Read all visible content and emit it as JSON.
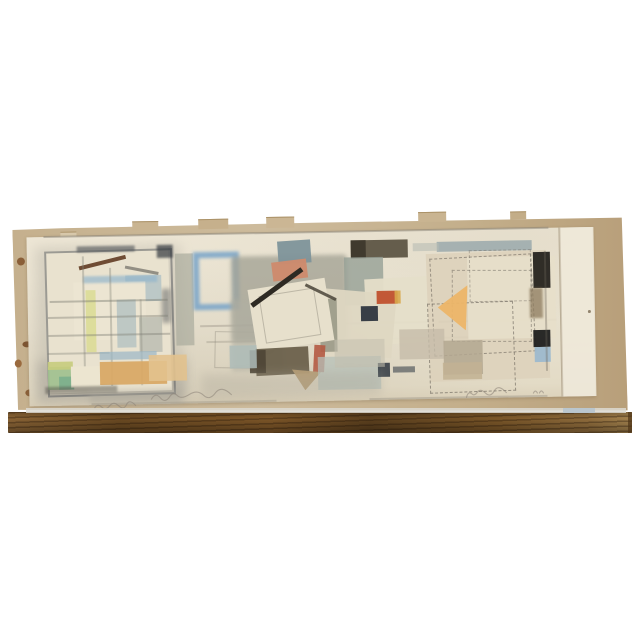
{
  "meta": {
    "scene": "product photograph of an abstract horizontal painting on paper resting on a wooden ledge against a white wall",
    "artwork_style": "mid-century abstract watercolor and collage with pencil grid, three cluster zones"
  },
  "palette": {
    "background": "#ffffff",
    "wood_dark": "#5c401e",
    "wood_mid": "#7d5628",
    "wood_light": "#a3824e",
    "ledge_highlight": "#dcd9d1",
    "ledge_highlight_blue": "#b7c4cd",
    "backing_tan": "#c8b38f",
    "paper_cream": "#e9e2d0",
    "pencil": "#8a8478",
    "charcoal": "#3f444b",
    "wash_gray": "#a5a496",
    "crayon_blue": "#6f9fc8",
    "slate_blue": "#7e939a",
    "salmon": "#cf8a6d",
    "umber": "#5e5544",
    "red_accent": "#c0512e",
    "navy": "#262e38",
    "ochre": "#ecb568",
    "tan_block": "#d9a966",
    "green_block": "#9fc08d",
    "black_block": "#1f1f1f",
    "light_blue_square": "#9db9ce"
  },
  "inscriptions": [
    {
      "name": "inscription-bottom-left",
      "medium": "pencil",
      "legibility": "illegible faint script"
    },
    {
      "name": "inscription-bottom-center",
      "medium": "pencil",
      "legibility": "illegible faint script title"
    },
    {
      "name": "inscription-signature-right",
      "medium": "pencil",
      "legibility": "illegible faint signature"
    },
    {
      "name": "inscription-date-mark",
      "medium": "pencil",
      "legibility": "tiny faint two-character mark"
    }
  ],
  "backing": {
    "tabs": [
      {
        "n": "torn-tab",
        "x": 134,
        "y": 218,
        "w": 26,
        "h": 8,
        "c": "#c9b491"
      },
      {
        "n": "torn-tab",
        "x": 200,
        "y": 217,
        "w": 30,
        "h": 9,
        "c": "#c6b08c"
      },
      {
        "n": "torn-tab",
        "x": 268,
        "y": 216,
        "w": 28,
        "h": 10,
        "c": "#cbb694"
      },
      {
        "n": "torn-tab",
        "x": 420,
        "y": 214,
        "w": 28,
        "h": 9,
        "c": "#c9b491"
      },
      {
        "n": "torn-tab",
        "x": 512,
        "y": 215,
        "w": 16,
        "h": 7,
        "c": "#c3ad88"
      },
      {
        "n": "tape-remnant",
        "x": 62,
        "y": 227,
        "w": 16,
        "h": 12,
        "c": "#d8c9ab"
      }
    ],
    "stains": [
      {
        "n": "stain",
        "x": 18,
        "y": 252,
        "w": 8,
        "h": 8,
        "c": "#8a5f38"
      },
      {
        "n": "stain",
        "x": 22,
        "y": 336,
        "w": 9,
        "h": 6,
        "c": "#7d5532"
      },
      {
        "n": "stain",
        "x": 14,
        "y": 354,
        "w": 7,
        "h": 8,
        "c": "#9a6a3e"
      },
      {
        "n": "stain",
        "x": 24,
        "y": 384,
        "w": 9,
        "h": 7,
        "c": "#8a5f38"
      }
    ]
  },
  "shapes": [
    {
      "n": "left-panel-halo",
      "x": 36,
      "y": 242,
      "w": 146,
      "h": 152,
      "c": "#b3afa3",
      "o": 0.38,
      "bl": 6
    },
    {
      "n": "left-panel-halo-bottom",
      "x": 36,
      "y": 356,
      "w": 150,
      "h": 42,
      "c": "#a6a298",
      "o": 0.45,
      "bl": 5
    },
    {
      "n": "left-panel-face",
      "x": 46,
      "y": 246,
      "w": 124,
      "h": 142,
      "c": "#e9e2cf",
      "r": -0.5
    },
    {
      "n": "left-panel-outline",
      "x": 46,
      "y": 246,
      "w": 124,
      "h": 142,
      "so": "#4e5257",
      "o": 0.5,
      "r": -0.5
    },
    {
      "n": "left-panel-top-smudge",
      "x": 78,
      "y": 242,
      "w": 58,
      "h": 6,
      "c": "#3f444b",
      "o": 0.55,
      "bl": 1
    },
    {
      "n": "left-panel-corner-smudge",
      "x": 158,
      "y": 242,
      "w": 16,
      "h": 13,
      "c": "#33383f",
      "o": 0.7,
      "bl": 1
    },
    {
      "n": "left-panel-right-smudge",
      "x": 162,
      "y": 286,
      "w": 9,
      "h": 34,
      "c": "#4a4f55",
      "o": 0.45,
      "bl": 2
    },
    {
      "n": "house-bluegray-block",
      "x": 126,
      "y": 272,
      "w": 36,
      "h": 26,
      "c": "#b7c5c5",
      "o": 0.9
    },
    {
      "n": "house-wall",
      "x": 74,
      "y": 278,
      "w": 72,
      "h": 58,
      "c": "#ece5d2"
    },
    {
      "n": "house-blue-eave",
      "x": 84,
      "y": 272,
      "w": 74,
      "h": 7,
      "c": "#8fb4cc",
      "o": 0.65,
      "bl": 1
    },
    {
      "n": "house-roof-beam",
      "x": 80,
      "y": 262,
      "w": 48,
      "h": 4,
      "c": "#6f4c34",
      "r": -13,
      "ln": 1
    },
    {
      "n": "house-roof-right",
      "x": 126,
      "y": 262,
      "w": 34,
      "h": 3,
      "c": "#7d7a70",
      "r": 12,
      "ln": 1,
      "o": 0.8
    },
    {
      "n": "yellow-strip",
      "x": 86,
      "y": 286,
      "w": 10,
      "h": 62,
      "c": "#dcdc96",
      "o": 0.9
    },
    {
      "n": "bluegray-column",
      "x": 117,
      "y": 296,
      "w": 19,
      "h": 48,
      "c": "#b6c3c2",
      "o": 0.85
    },
    {
      "n": "gray-block-mid",
      "x": 139,
      "y": 314,
      "w": 23,
      "h": 35,
      "c": "#b9bcb0",
      "o": 0.8
    },
    {
      "n": "panel-grid-h1",
      "x": 50,
      "y": 296,
      "w": 118,
      "h": 2,
      "c": "#7e7e74",
      "o": 0.45
    },
    {
      "n": "panel-grid-h2",
      "x": 48,
      "y": 312,
      "w": 120,
      "h": 2,
      "c": "#7e7e74",
      "o": 0.4
    },
    {
      "n": "panel-grid-h3",
      "x": 48,
      "y": 330,
      "w": 122,
      "h": 2,
      "c": "#7e7e74",
      "o": 0.4
    },
    {
      "n": "panel-grid-h4",
      "x": 47,
      "y": 348,
      "w": 62,
      "h": 2,
      "c": "#7e7e74",
      "o": 0.35
    },
    {
      "n": "panel-grid-v1",
      "x": 83,
      "y": 252,
      "w": 2,
      "h": 130,
      "c": "#7e7e74",
      "o": 0.35
    },
    {
      "n": "panel-grid-v2",
      "x": 110,
      "y": 264,
      "w": 2,
      "h": 118,
      "c": "#7e7e74",
      "o": 0.35
    },
    {
      "n": "panel-grid-v3",
      "x": 140,
      "y": 296,
      "w": 2,
      "h": 86,
      "c": "#7e7e74",
      "o": 0.3
    },
    {
      "n": "blue-strokes",
      "x": 99,
      "y": 348,
      "w": 57,
      "h": 8,
      "c": "#9ab6c6",
      "o": 0.7
    },
    {
      "n": "green-block",
      "x": 47,
      "y": 362,
      "w": 23,
      "h": 23,
      "c": "#9fc08d",
      "o": 0.9
    },
    {
      "n": "teal-block",
      "x": 58,
      "y": 372,
      "w": 15,
      "h": 13,
      "c": "#79ae8c",
      "o": 0.85
    },
    {
      "n": "yellowgreen-cap",
      "x": 47,
      "y": 357,
      "w": 25,
      "h": 8,
      "c": "#c6cc7c",
      "o": 0.9
    },
    {
      "n": "cream-step",
      "x": 70,
      "y": 362,
      "w": 30,
      "h": 21,
      "c": "#ece5d0"
    },
    {
      "n": "tan-block",
      "x": 99,
      "y": 358,
      "w": 67,
      "h": 23,
      "c": "#d9a966",
      "o": 0.95
    },
    {
      "n": "tan-block-light",
      "x": 148,
      "y": 352,
      "w": 38,
      "h": 26,
      "c": "#e2c28e",
      "o": 0.9
    },
    {
      "n": "panel-bottom-smudge",
      "x": 44,
      "y": 382,
      "w": 72,
      "h": 7,
      "c": "#55534c",
      "o": 0.5,
      "bl": 1
    },
    {
      "n": "panel-bottom-wash",
      "x": 88,
      "y": 386,
      "w": 92,
      "h": 14,
      "c": "#aaa69a",
      "o": 0.45,
      "bl": 3
    },
    {
      "n": "gray-vstrip",
      "x": 176,
      "y": 251,
      "w": 18,
      "h": 92,
      "c": "#a9ab9d",
      "o": 0.7
    },
    {
      "n": "blue-square-outline",
      "x": 194,
      "y": 250,
      "w": 34,
      "h": 46,
      "so": "#6f9fc8",
      "bw": 6,
      "o": 0.8,
      "bl": 1.5
    },
    {
      "n": "top-border-line",
      "x": 45,
      "y": 231,
      "w": 505,
      "h": 2,
      "c": "#8a8478",
      "o": 0.5
    },
    {
      "n": "grid-line-mid-h1",
      "x": 200,
      "y": 323,
      "w": 356,
      "h": 2,
      "c": "#8a8478",
      "o": 0.35
    },
    {
      "n": "grid-line-mid-h2",
      "x": 206,
      "y": 339,
      "w": 340,
      "h": 2,
      "c": "#8a8478",
      "o": 0.3
    },
    {
      "n": "faint-quad",
      "x": 214,
      "y": 330,
      "w": 45,
      "h": 35,
      "so": "#8a8478",
      "bw": 1.5,
      "o": 0.4,
      "r": 2
    },
    {
      "n": "gray-oval",
      "x": 255,
      "y": 344,
      "w": 19,
      "h": 10,
      "c": "#8f9086",
      "br": "50%",
      "o": 0.8
    },
    {
      "n": "bottom-line-left",
      "x": 90,
      "y": 399,
      "w": 185,
      "h": 2,
      "c": "#8a8478",
      "o": 0.3
    },
    {
      "n": "bottom-line-right",
      "x": 368,
      "y": 399,
      "w": 178,
      "h": 2,
      "c": "#8a8478",
      "o": 0.35
    },
    {
      "n": "mid-wash",
      "x": 232,
      "y": 255,
      "w": 116,
      "h": 86,
      "c": "#a5a496",
      "o": 0.8,
      "bl": 2,
      "br": "4px"
    },
    {
      "n": "mid-wash-low",
      "x": 231,
      "y": 298,
      "w": 52,
      "h": 72,
      "c": "#b0afa2",
      "o": 0.55,
      "bl": 2
    },
    {
      "n": "slate-rect",
      "x": 279,
      "y": 240,
      "w": 33,
      "h": 23,
      "c": "#7e939a",
      "r": -3,
      "o": 0.95
    },
    {
      "n": "salmon-rect",
      "x": 273,
      "y": 260,
      "w": 35,
      "h": 19,
      "c": "#cf8a6d",
      "r": -6,
      "o": 0.95
    },
    {
      "n": "umber-rect",
      "x": 352,
      "y": 241,
      "w": 57,
      "h": 18,
      "c": "#5e5544",
      "o": 0.95
    },
    {
      "n": "umber-rect-dark",
      "x": 352,
      "y": 241,
      "w": 15,
      "h": 18,
      "c": "#3e382c",
      "o": 0.95
    },
    {
      "n": "slategreen-block",
      "x": 345,
      "y": 258,
      "w": 39,
      "h": 48,
      "c": "#96a096",
      "o": 0.8
    },
    {
      "n": "mid-sheet-right",
      "x": 366,
      "y": 279,
      "w": 72,
      "h": 66,
      "c": "#e5dec9",
      "r": -2,
      "o": 0.95
    },
    {
      "n": "collage-sheet-right",
      "x": 322,
      "y": 292,
      "w": 72,
      "h": 64,
      "c": "#ded7c2",
      "r": 6,
      "o": 0.95
    },
    {
      "n": "torn-strip",
      "x": 320,
      "y": 299,
      "w": 17,
      "h": 53,
      "c": "#8e8d7c",
      "o": 0.75
    },
    {
      "n": "collage-square",
      "x": 252,
      "y": 283,
      "w": 78,
      "h": 63,
      "c": "#e7e0cc",
      "r": -8
    },
    {
      "n": "collage-inner-line",
      "x": 262,
      "y": 291,
      "w": 54,
      "h": 46,
      "so": "#8a8478",
      "bw": 1,
      "o": 0.45,
      "r": -8
    },
    {
      "n": "dark-slash",
      "x": 252,
      "y": 302,
      "w": 62,
      "h": 5,
      "c": "#2e2a23",
      "r": -35,
      "ln": 1
    },
    {
      "n": "slash-right",
      "x": 306,
      "y": 283,
      "w": 34,
      "h": 3,
      "c": "#4a4438",
      "r": 27,
      "ln": 1,
      "o": 0.85
    },
    {
      "n": "red-sliver",
      "x": 313,
      "y": 345,
      "w": 11,
      "h": 27,
      "c": "#b45a43",
      "r": 4,
      "o": 0.9
    },
    {
      "n": "olive-block",
      "x": 255,
      "y": 347,
      "w": 53,
      "h": 27,
      "c": "#6c614c",
      "r": -2,
      "o": 0.95
    },
    {
      "n": "olive-block-dark",
      "x": 249,
      "y": 349,
      "w": 16,
      "h": 23,
      "c": "#4f4737",
      "o": 0.95
    },
    {
      "n": "tan-triangle",
      "x": 291,
      "y": 369,
      "w": 29,
      "h": 21,
      "c": "#b49b72",
      "cp": "polygon(0 0,100% 15%,45% 100%)",
      "o": 0.95
    },
    {
      "n": "bluegray-block-a",
      "x": 229,
      "y": 344,
      "w": 27,
      "h": 23,
      "c": "#aebcb8",
      "o": 0.85
    },
    {
      "n": "bluegray-block-b",
      "x": 317,
      "y": 357,
      "w": 63,
      "h": 33,
      "c": "#b6c0b8",
      "o": 0.75
    },
    {
      "n": "navy-patch",
      "x": 361,
      "y": 307,
      "w": 17,
      "h": 15,
      "c": "#262e38",
      "o": 0.9
    },
    {
      "n": "red-block",
      "x": 377,
      "y": 292,
      "w": 21,
      "h": 13,
      "c": "#c0512e",
      "o": 0.95
    },
    {
      "n": "red-block-gold-edge",
      "x": 395,
      "y": 292,
      "w": 6,
      "h": 13,
      "c": "#d8a84c",
      "o": 0.9
    },
    {
      "n": "navy-dash-a",
      "x": 377,
      "y": 364,
      "w": 12,
      "h": 14,
      "c": "#2e3640",
      "o": 0.85
    },
    {
      "n": "navy-dash-b",
      "x": 392,
      "y": 368,
      "w": 22,
      "h": 6,
      "c": "#3c444c",
      "o": 0.6
    },
    {
      "n": "mid-low-wash",
      "x": 334,
      "y": 340,
      "w": 50,
      "h": 28,
      "c": "#c3bfae",
      "o": 0.55
    },
    {
      "n": "mid-bottom-wash",
      "x": 200,
      "y": 372,
      "w": 180,
      "h": 24,
      "c": "#a9a497",
      "o": 0.3,
      "bl": 5
    },
    {
      "n": "right-sheet",
      "x": 428,
      "y": 255,
      "w": 120,
      "h": 128,
      "c": "#ddd2bb",
      "o": 0.9,
      "r": -1
    },
    {
      "n": "right-sheet-light",
      "x": 468,
      "y": 260,
      "w": 88,
      "h": 82,
      "c": "#e7dfca",
      "o": 0.9
    },
    {
      "n": "grayblue-bar",
      "x": 438,
      "y": 244,
      "w": 95,
      "h": 10,
      "c": "#9aa9ab",
      "o": 0.85
    },
    {
      "n": "grayblue-bar-faint",
      "x": 414,
      "y": 245,
      "w": 26,
      "h": 8,
      "c": "#b8bdb4",
      "o": 0.6
    },
    {
      "n": "sketch-square-a",
      "x": 432,
      "y": 259,
      "w": 100,
      "h": 96,
      "d": "#6a635a",
      "bw": 1.5,
      "o": 0.6,
      "r": -2
    },
    {
      "n": "sketch-square-b",
      "x": 452,
      "y": 273,
      "w": 78,
      "h": 70,
      "d": "#6a635a",
      "bw": 1.5,
      "o": 0.5,
      "r": 1
    },
    {
      "n": "sketch-square-c",
      "x": 428,
      "y": 305,
      "w": 84,
      "h": 88,
      "d": "#5a544c",
      "bw": 1.5,
      "o": 0.55,
      "r": -1
    },
    {
      "n": "sketch-square-d",
      "x": 470,
      "y": 253,
      "w": 60,
      "h": 50,
      "d": "#6a635a",
      "bw": 1,
      "o": 0.4
    },
    {
      "n": "black-block",
      "x": 534,
      "y": 256,
      "w": 17,
      "h": 36,
      "c": "#26231f",
      "o": 0.95
    },
    {
      "n": "brown-drip",
      "x": 530,
      "y": 292,
      "w": 13,
      "h": 30,
      "c": "#8d7b5e",
      "o": 0.75,
      "bl": 1
    },
    {
      "n": "ochre-triangle",
      "x": 438,
      "y": 288,
      "w": 30,
      "h": 45,
      "c": "#ecb568",
      "cp": "polygon(0 48%,100% 0,92% 100%)",
      "o": 0.95
    },
    {
      "n": "beige-block-a",
      "x": 399,
      "y": 331,
      "w": 45,
      "h": 30,
      "c": "#c6bca9",
      "o": 0.8
    },
    {
      "n": "taupe-block",
      "x": 443,
      "y": 343,
      "w": 39,
      "h": 34,
      "c": "#b3a791",
      "o": 0.85
    },
    {
      "n": "tan-block-low",
      "x": 442,
      "y": 365,
      "w": 39,
      "h": 17,
      "c": "#c2b193",
      "o": 0.85
    },
    {
      "n": "black-square",
      "x": 533,
      "y": 334,
      "w": 17,
      "h": 17,
      "c": "#1f1f1f",
      "o": 0.95
    },
    {
      "n": "lightblue-square",
      "x": 534,
      "y": 351,
      "w": 16,
      "h": 15,
      "c": "#9db9ce",
      "o": 0.95
    },
    {
      "n": "right-edge-line",
      "x": 545,
      "y": 255,
      "w": 2,
      "h": 120,
      "c": "#6a635a",
      "o": 0.35
    },
    {
      "n": "sheet-edge-line",
      "x": 560,
      "y": 232,
      "w": 1.5,
      "h": 169,
      "c": "#b1a68f",
      "o": 0.5
    },
    {
      "n": "pencil-dot",
      "x": 588,
      "y": 315,
      "w": 3,
      "h": 3,
      "c": "#7a6a52",
      "br": "50%",
      "o": 0.8
    }
  ]
}
